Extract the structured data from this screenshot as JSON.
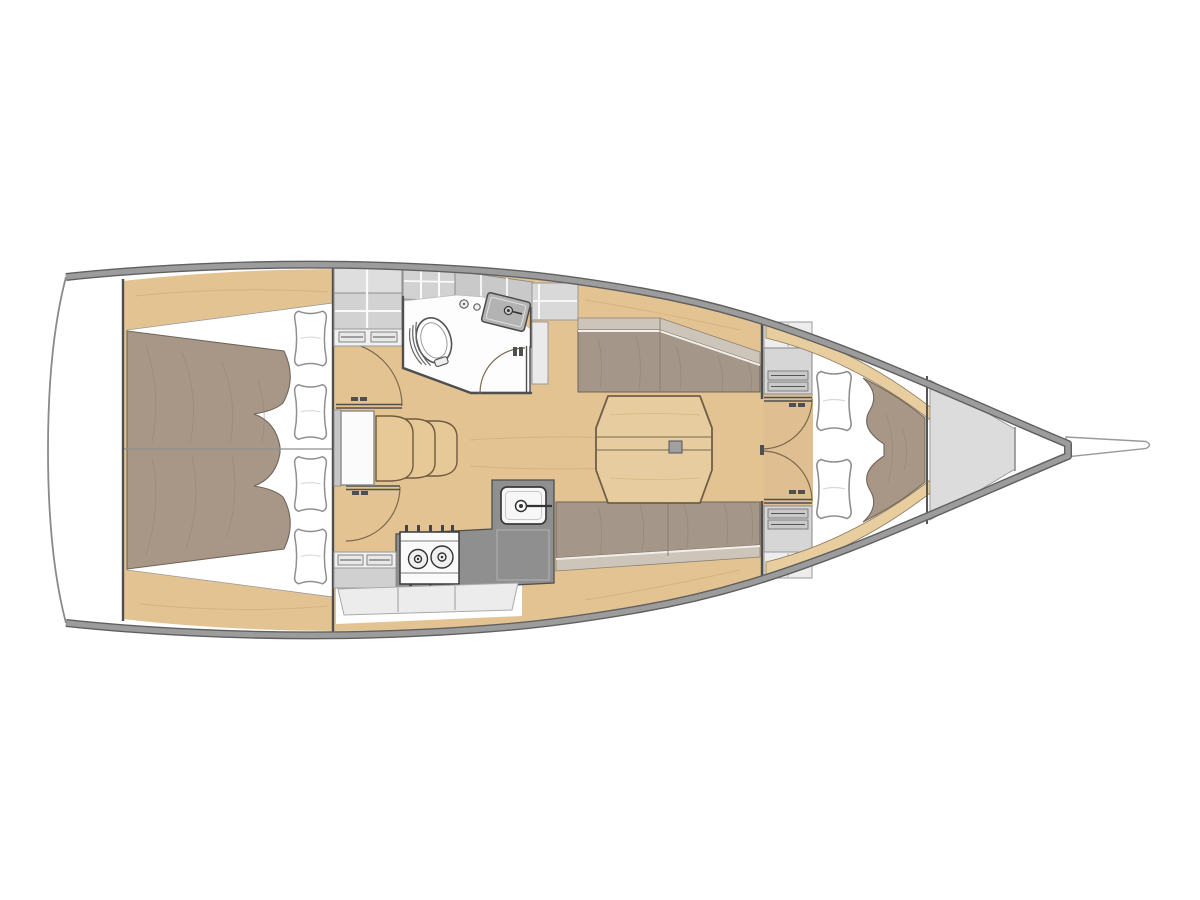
{
  "title": "Sailing yacht interior layout — top-down deck plan, bow to the right",
  "palette": {
    "background": "#ffffff",
    "hull_band": "#9c9c9c",
    "hull_band_edge": "#606060",
    "transom_line": "#8a8a8a",
    "wood": "#e4c392",
    "wood_trim": "#e8cd9f",
    "wood_outline": "#6e5a40",
    "floor_wood": "#dfbf92",
    "duvet": "#a89786",
    "duvet_outline": "#6f665c",
    "pillow_white": "#ffffff",
    "pillow_outline": "#8f8f8f",
    "seat": "#a5968a",
    "backrest": "#cdc5b9",
    "cabinet": "#d2d2d2",
    "cabinet_light": "#ededed",
    "cabinet_outline": "#8f8f8f",
    "counter_dark": "#8f8f8f",
    "appliance_outline": "#3a3a3a",
    "sink_metal": "#b3b3b3",
    "forepeak": "#dcdcdc",
    "wall": "#4f4f4f",
    "head_floor": "#fdfdfd",
    "table_wood": "#e7cc9f",
    "step_wood": "#e6c997",
    "drawer_face": "#f0f0f0",
    "white_margin": "#ffffff"
  },
  "vessel": {
    "view": "top-down interior plan",
    "orientation": "bow-right",
    "aft_cabin": {
      "berth": "double",
      "pillows": 4
    },
    "forward_cabin": {
      "berth": "v-berth",
      "pillows": 2
    },
    "galley": {
      "burners": 2,
      "sinks": 1
    },
    "wet_head": {
      "toilet": 1,
      "sink": 1
    },
    "saloon": {
      "settees": 2,
      "table": "octagonal folding table"
    },
    "companionway": {
      "steps": 3
    },
    "areas": [
      "transom",
      "aft double cabin",
      "companionway steps",
      "wet head",
      "galley",
      "saloon",
      "port settee",
      "starboard settee",
      "forward v-berth cabin",
      "anchor locker",
      "bowsprit"
    ]
  }
}
